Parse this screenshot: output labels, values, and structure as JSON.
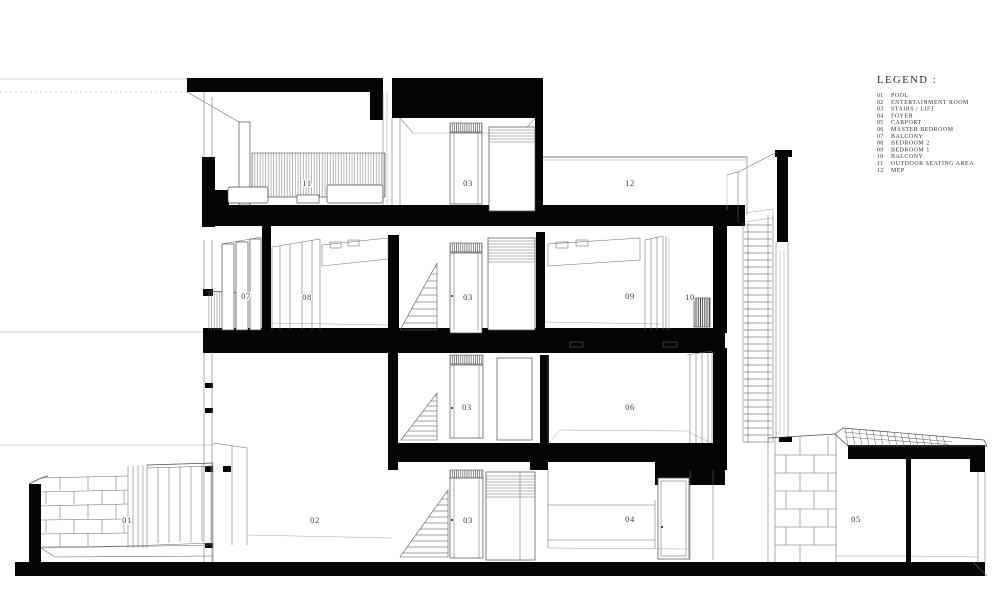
{
  "drawing": {
    "type": "architectural-section",
    "description": "Sectional perspective drawing of a four-storey residence"
  },
  "legend": {
    "title": "LEGEND :",
    "items": [
      {
        "num": "01",
        "label": "POOL"
      },
      {
        "num": "02",
        "label": "ENTERTAINMENT ROOM"
      },
      {
        "num": "03",
        "label": "STAIRS / LIFT"
      },
      {
        "num": "04",
        "label": "FOYER"
      },
      {
        "num": "05",
        "label": "CARPORT"
      },
      {
        "num": "06",
        "label": "MASTER BEDROOM"
      },
      {
        "num": "07",
        "label": "BALCONY"
      },
      {
        "num": "08",
        "label": "BEDROOM 2"
      },
      {
        "num": "09",
        "label": "BEDROOM 1"
      },
      {
        "num": "10",
        "label": "BALCONY"
      },
      {
        "num": "11",
        "label": "OUTDOOR SEATING AREA"
      },
      {
        "num": "12",
        "label": "MEP"
      }
    ]
  },
  "room_labels": [
    {
      "id": "pool",
      "num": "01"
    },
    {
      "id": "entertainment-room",
      "num": "02"
    },
    {
      "id": "stairs-ground",
      "num": "03"
    },
    {
      "id": "foyer",
      "num": "04"
    },
    {
      "id": "carport",
      "num": "05"
    },
    {
      "id": "stairs-level2",
      "num": "03"
    },
    {
      "id": "master-bedroom",
      "num": "06"
    },
    {
      "id": "balcony-upper-left",
      "num": "07"
    },
    {
      "id": "bedroom-2",
      "num": "08"
    },
    {
      "id": "stairs-level3",
      "num": "03"
    },
    {
      "id": "bedroom-1",
      "num": "09"
    },
    {
      "id": "balcony-upper-right",
      "num": "10"
    },
    {
      "id": "outdoor-seating",
      "num": "11"
    },
    {
      "id": "stairs-level4",
      "num": "03"
    },
    {
      "id": "mep",
      "num": "12"
    }
  ],
  "colors": {
    "ink": "#050505",
    "line": "#4a4a4a",
    "faint": "#9f9f9f",
    "background": "#ffffff"
  }
}
